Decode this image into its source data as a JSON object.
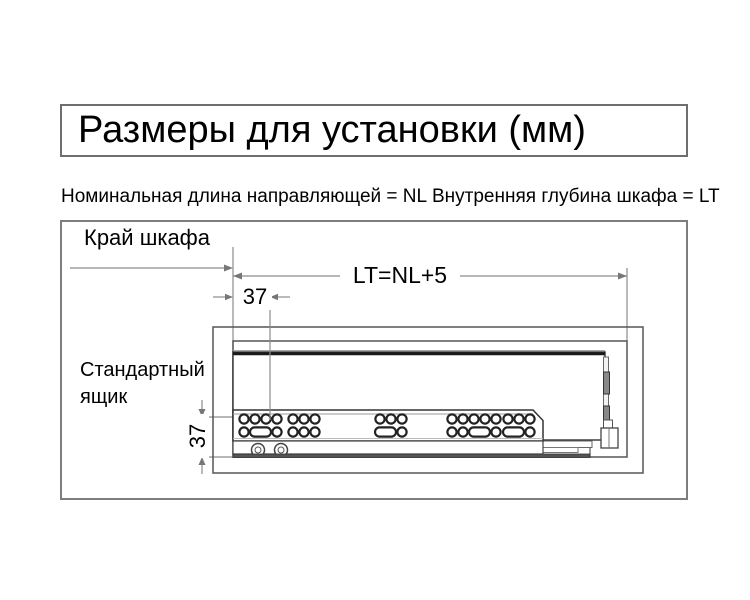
{
  "title": "Размеры для установки (мм)",
  "legend": {
    "nominal_length": "Номинальная длина направляющей = NL",
    "inner_depth": "Внутренняя глубина шкафа = LT"
  },
  "diagram": {
    "cabinet_edge_label": "Край шкафа",
    "depth_dimension_label": "LT=NL+5",
    "front_offset_mm": "37",
    "vertical_offset_mm": "37",
    "drawer_label": "Стандартный\nящик",
    "colors": {
      "dimension_lines": "#8c8c8c",
      "drawing_lines": "#555555",
      "rail_lines": "#333333",
      "hole_stroke": "#222222",
      "text": "#000000",
      "background": "#ffffff"
    },
    "slide_rail": {
      "hole_r": 4.6,
      "oval_w": 21,
      "oval_h": 9.2,
      "top_cy": 199,
      "bottom_cy": 212,
      "groups": [
        {
          "top": [
            184,
            195,
            206,
            217
          ],
          "bottom": [
            {
              "t": "c",
              "cx": 184
            },
            {
              "t": "o",
              "cx": 200.5
            },
            {
              "t": "c",
              "cx": 217
            }
          ]
        },
        {
          "top": [
            233,
            244,
            255
          ],
          "bottom": [
            {
              "t": "c",
              "cx": 233
            },
            {
              "t": "c",
              "cx": 244
            },
            {
              "t": "c",
              "cx": 255
            }
          ]
        },
        {
          "top": [
            320,
            331,
            342
          ],
          "bottom": [
            {
              "t": "o",
              "cx": 325.5
            },
            {
              "t": "c",
              "cx": 342
            }
          ]
        },
        {
          "top": [
            392,
            403
          ],
          "bottom": [
            {
              "t": "c",
              "cx": 392
            },
            {
              "t": "c",
              "cx": 403
            }
          ]
        },
        {
          "top": [
            414,
            425,
            436
          ],
          "bottom": [
            {
              "t": "o",
              "cx": 419.5
            },
            {
              "t": "c",
              "cx": 436
            }
          ]
        },
        {
          "top": [
            448,
            459,
            470
          ],
          "bottom": [
            {
              "t": "o",
              "cx": 453.5
            },
            {
              "t": "c",
              "cx": 470
            }
          ]
        }
      ]
    }
  }
}
